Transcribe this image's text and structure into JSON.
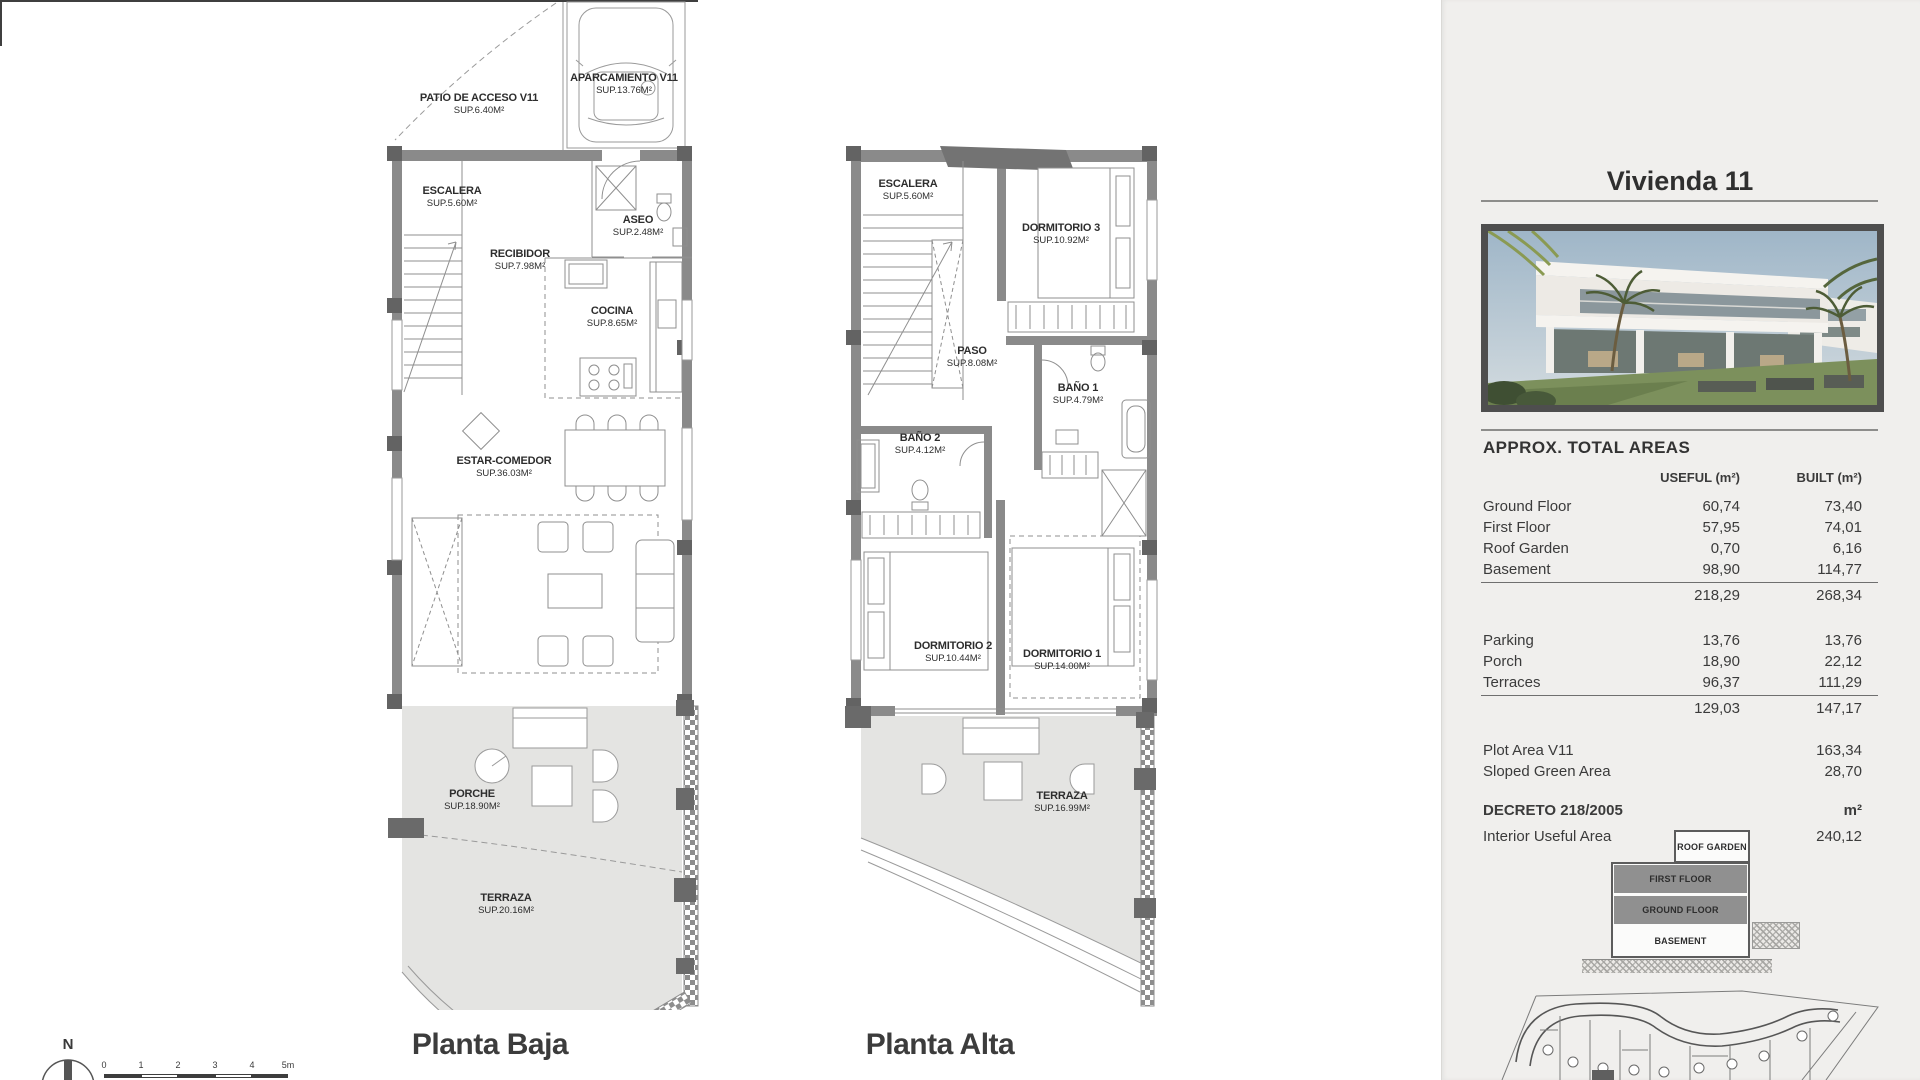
{
  "panel": {
    "title": "Vivienda 11",
    "areas": {
      "heading": "APPROX. TOTAL AREAS",
      "col_useful": "USEFUL (m²)",
      "col_built": "BUILT (m²)",
      "rows": [
        {
          "label": "Ground Floor",
          "useful": "60,74",
          "built": "73,40"
        },
        {
          "label": "First Floor",
          "useful": "57,95",
          "built": "74,01"
        },
        {
          "label": "Roof Garden",
          "useful": "0,70",
          "built": "6,16"
        },
        {
          "label": "Basement",
          "useful": "98,90",
          "built": "114,77"
        }
      ],
      "subtotal1": {
        "useful": "218,29",
        "built": "268,34"
      },
      "rows2": [
        {
          "label": "Parking",
          "useful": "13,76",
          "built": "13,76"
        },
        {
          "label": "Porch",
          "useful": "18,90",
          "built": "22,12"
        },
        {
          "label": "Terraces",
          "useful": "96,37",
          "built": "111,29"
        }
      ],
      "subtotal2": {
        "useful": "129,03",
        "built": "147,17"
      },
      "extra": [
        {
          "label": "Plot Area V11",
          "value": "163,34"
        },
        {
          "label": "Sloped Green Area",
          "value": "28,70"
        }
      ],
      "decreto": {
        "label": "DECRETO 218/2005",
        "unit": "m²"
      },
      "interior": {
        "label": "Interior Useful Area",
        "value": "240,12"
      }
    },
    "stack": {
      "levels": [
        "ROOF GARDEN",
        "FIRST FLOOR",
        "GROUND FLOOR",
        "BASEMENT"
      ]
    }
  },
  "plans": {
    "baja": {
      "title": "Planta Baja",
      "rooms": [
        {
          "name": "PATIO DE ACCESO V11",
          "sup": "SUP.6.40M²"
        },
        {
          "name": "APARCAMIENTO V11",
          "sup": "SUP.13.76M²"
        },
        {
          "name": "ESCALERA",
          "sup": "SUP.5.60M²"
        },
        {
          "name": "ASEO",
          "sup": "SUP.2.48M²"
        },
        {
          "name": "RECIBIDOR",
          "sup": "SUP.7.98M²"
        },
        {
          "name": "COCINA",
          "sup": "SUP.8.65M²"
        },
        {
          "name": "ESTAR-COMEDOR",
          "sup": "SUP.36.03M²"
        },
        {
          "name": "PORCHE",
          "sup": "SUP.18.90M²"
        },
        {
          "name": "TERRAZA",
          "sup": "SUP.20.16M²"
        }
      ]
    },
    "alta": {
      "title": "Planta Alta",
      "rooms": [
        {
          "name": "ESCALERA",
          "sup": "SUP.5.60M²"
        },
        {
          "name": "DORMITORIO 3",
          "sup": "SUP.10.92M²"
        },
        {
          "name": "PASO",
          "sup": "SUP.8.08M²"
        },
        {
          "name": "BAÑO 1",
          "sup": "SUP.4.79M²"
        },
        {
          "name": "BAÑO 2",
          "sup": "SUP.4.12M²"
        },
        {
          "name": "DORMITORIO 2",
          "sup": "SUP.10.44M²"
        },
        {
          "name": "DORMITORIO 1",
          "sup": "SUP.14.00M²"
        },
        {
          "name": "TERRAZA",
          "sup": "SUP.16.99M²"
        }
      ]
    },
    "compass": "N",
    "scale": [
      "0",
      "1",
      "2",
      "3",
      "4",
      "5m"
    ]
  },
  "colors": {
    "panel_bg": "#f0efed",
    "wall_gray": "#8a8a8a",
    "pillar_dark": "#636363",
    "terrace_fill": "#e4e4e2",
    "frame_dark": "#4e4e4e",
    "stack_gray": "#909090"
  }
}
